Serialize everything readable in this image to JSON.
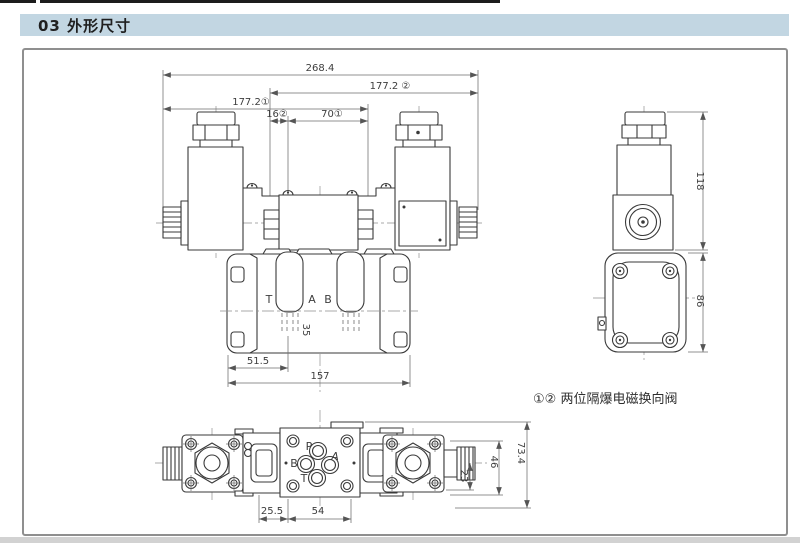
{
  "header": {
    "title": "03 外形尺寸"
  },
  "note": {
    "text": "①② 两位隔爆电磁换向阀"
  },
  "front_view": {
    "dims": {
      "overall_width": "268.4",
      "width_v2": "177.2 ②",
      "width_v1": "177.2①",
      "offset16": "16②",
      "offset70": "70①",
      "depth35": "35",
      "offset51_5": "51.5",
      "width157": "157"
    },
    "ports": {
      "t": "T",
      "a": "A",
      "b": "B"
    }
  },
  "side_view": {
    "dims": {
      "height118": "118",
      "height86": "86"
    }
  },
  "bottom_view": {
    "dims": {
      "offset25_5": "25.5",
      "spacing54": "54",
      "offset23": "23",
      "spacing46": "46",
      "depth73_4": "73.4"
    },
    "ports": {
      "p": "P",
      "a": "A",
      "b": "B",
      "t": "T"
    }
  },
  "colors": {
    "header_bg": "#c2d6e2",
    "line": "#3a3a3a",
    "dim_text": "#3d3d3d"
  }
}
